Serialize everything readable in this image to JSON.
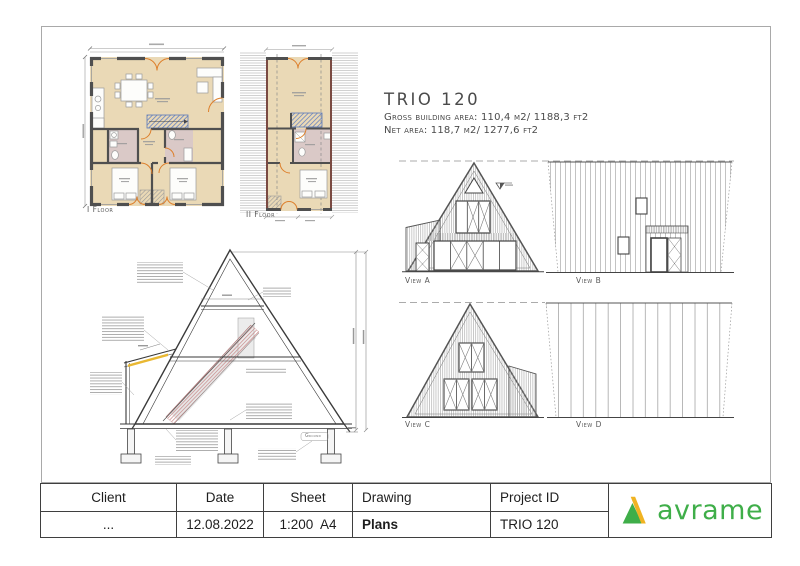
{
  "heading": {
    "title": "TRIO 120",
    "line1": "Gross building area: 110,4 m2/ 1188,3 ft2",
    "line2": "Net area: 118,7 m2/ 1277,6 ft2"
  },
  "labels": {
    "floor1": "I Floor",
    "floor2": "II Floor",
    "view_a": "View A",
    "view_b": "View B",
    "view_c": "View C",
    "view_d": "View D",
    "ground": "Ground"
  },
  "title_block": {
    "headers": [
      "Client",
      "Date",
      "Sheet",
      "Drawing",
      "Project ID"
    ],
    "values": [
      "...",
      "12.08.2022",
      "1:200  A4",
      "Plans",
      "TRIO 120"
    ],
    "logo_text": "avrame"
  },
  "palette": {
    "logo_green": "#3fae49",
    "logo_yellow": "#f0b322",
    "plan_floor_beige": "#ead9b6",
    "plan_room_pink": "#dac9c7",
    "door_orange": "#dd7f2b",
    "stair_blue": "#6b85c0",
    "section_rail_pink": "#c98b8b",
    "insulation_yellow": "#e9b832"
  }
}
